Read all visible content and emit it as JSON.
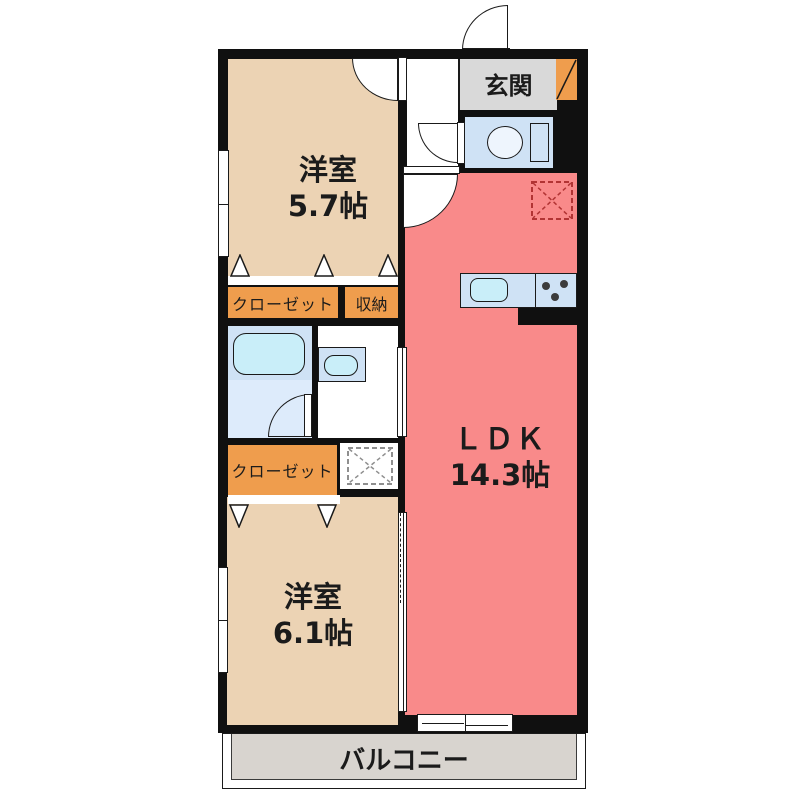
{
  "plan": {
    "genkan": {
      "label": "玄関"
    },
    "bedroom1": {
      "name": "洋室",
      "area": "5.7帖"
    },
    "closet1": {
      "label": "クローゼット"
    },
    "storage": {
      "label": "収納"
    },
    "ldk": {
      "name": "ＬＤＫ",
      "area": "14.3帖"
    },
    "closet2": {
      "label": "クローゼット"
    },
    "bedroom2": {
      "name": "洋室",
      "area": "6.1帖"
    },
    "balcony": {
      "label": "バルコニー"
    },
    "colors": {
      "wall": "#101010",
      "bedroom": "#ecd3b4",
      "ldk": "#f98a8a",
      "closet_label": "#ef9d4d",
      "genkan_floor": "#d9d9d9",
      "balcony_floor": "#d8d4cf",
      "wet_area": "#cfe2f5",
      "wet_area_light": "#ddebfb",
      "fixture_cyan": "#c9eef9",
      "fridge_dash": "#b23434",
      "washer_dash": "#8f8f8f"
    },
    "icons": {
      "bathtub": "rounded-rect",
      "toilet": "ellipse-bowl-plus-tank",
      "washbasin": "oval-sink",
      "kitchen-sink": "rounded-rect",
      "stove-burners": "three-dots",
      "refrigerator-space": "dashed-square-x",
      "washing-machine-space": "dashed-square-x",
      "door-swing": "quarter-arc",
      "folding-door": "triangle",
      "window": "double-line-rect",
      "sliding-door": "thin-rail-rect"
    }
  }
}
